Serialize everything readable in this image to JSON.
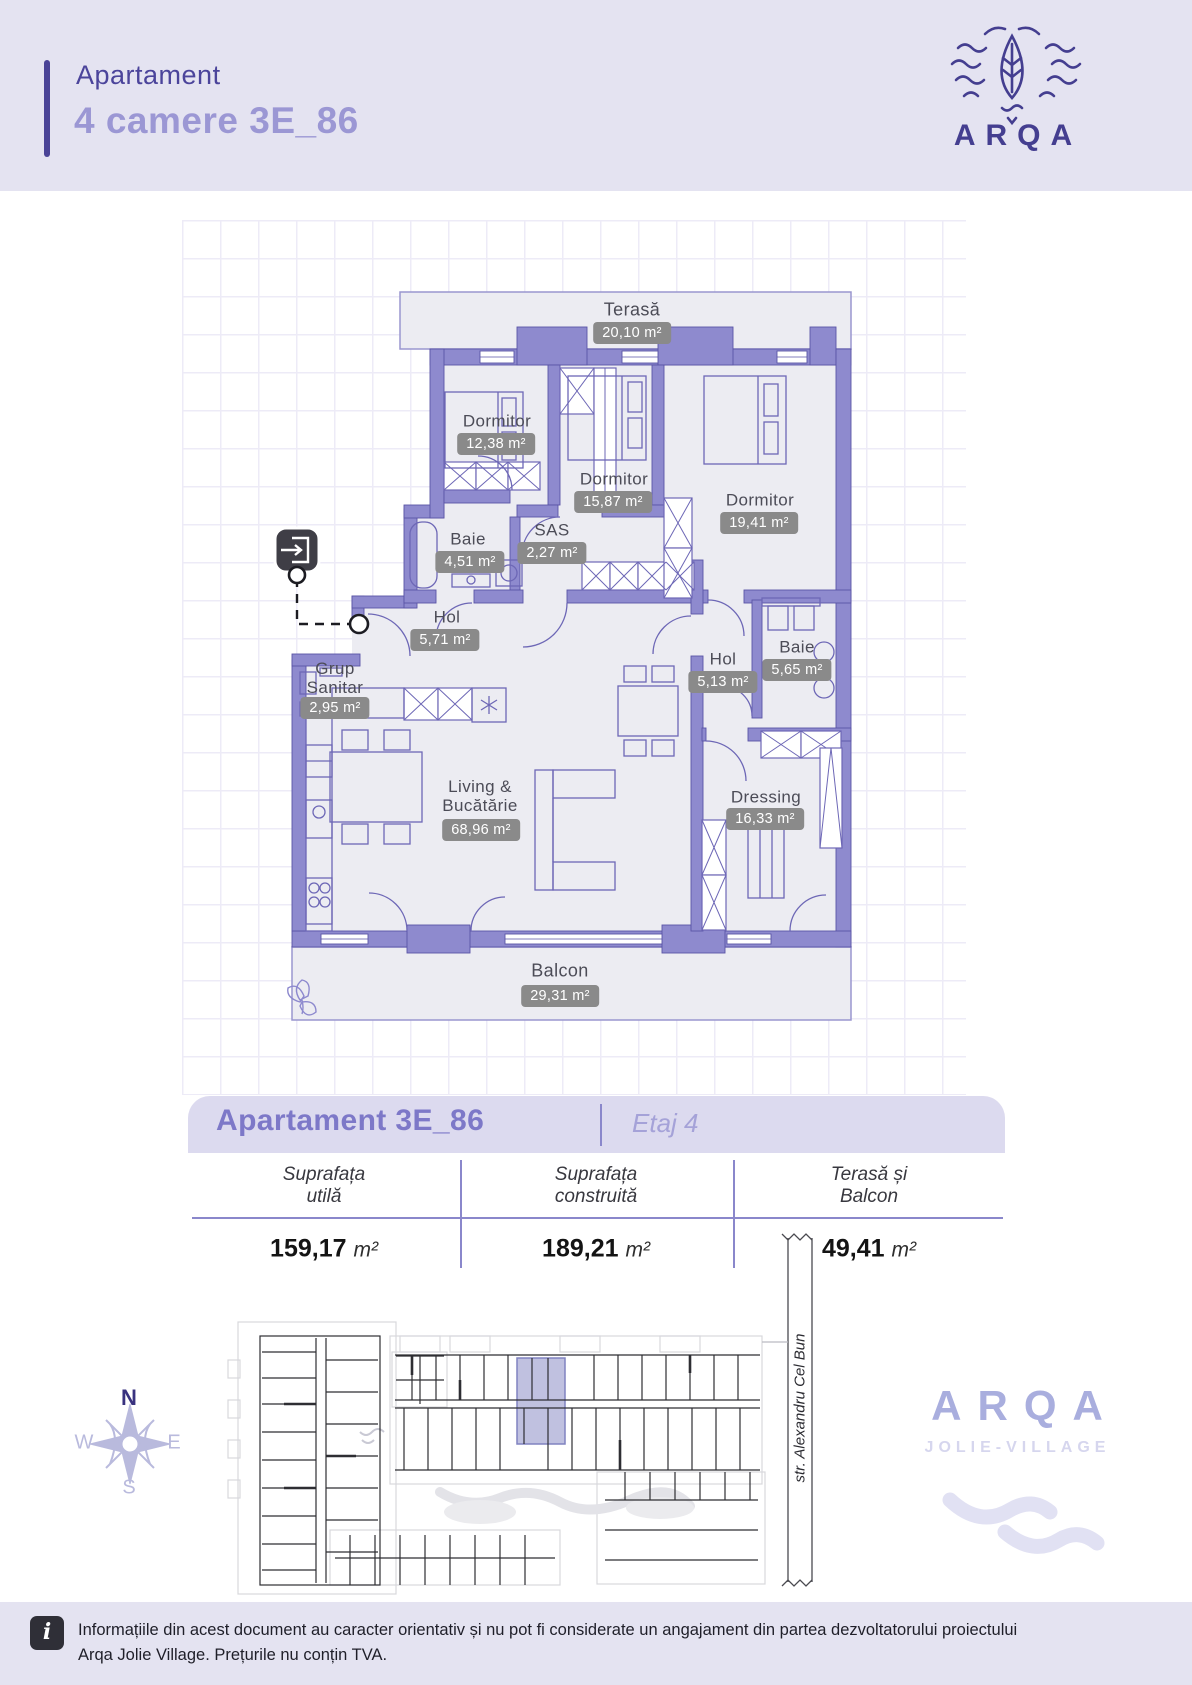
{
  "header": {
    "label": "Apartament",
    "title": "4 camere 3E_86"
  },
  "brand": {
    "name": "ARQA",
    "subtitle": "JOLIE-VILLAGE"
  },
  "floor_plan": {
    "rooms": [
      {
        "name": "Terasă",
        "area": "20,10 m²"
      },
      {
        "name": "Dormitor",
        "area": "12,38 m²"
      },
      {
        "name": "Dormitor",
        "area": "15,87 m²"
      },
      {
        "name": "Dormitor",
        "area": "19,41 m²"
      },
      {
        "name": "Baie",
        "area": "4,51 m²"
      },
      {
        "name": "SAS",
        "area": "2,27 m²"
      },
      {
        "name": "Hol",
        "area": "5,71 m²"
      },
      {
        "name": "Grup Sanitar",
        "area": "2,95 m²"
      },
      {
        "name": "Hol",
        "area": "5,13 m²"
      },
      {
        "name": "Baie",
        "area": "5,65 m²"
      },
      {
        "name": "Living & Bucătărie",
        "area": "68,96 m²"
      },
      {
        "name": "Dressing",
        "area": "16,33 m²"
      },
      {
        "name": "Balcon",
        "area": "29,31 m²"
      }
    ]
  },
  "summary": {
    "title": "Apartament 3E_86",
    "floor": "Etaj 4",
    "columns": [
      {
        "label_line1": "Suprafața",
        "label_line2": "utilă",
        "value": "159,17",
        "unit": "m²"
      },
      {
        "label_line1": "Suprafața",
        "label_line2": "construită",
        "value": "189,21",
        "unit": "m²"
      },
      {
        "label_line1": "Terasă și",
        "label_line2": "Balcon",
        "value": "49,41",
        "unit": "m²"
      }
    ]
  },
  "site": {
    "street": "str. Alexandru Cel Bun",
    "compass": {
      "n": "N",
      "e": "E",
      "s": "S",
      "w": "W"
    }
  },
  "footer": {
    "info_icon": "i",
    "text_line1": "Informațiile din acest document au caracter orientativ și nu pot fi considerate un angajament din partea dezvoltatorului proiectului",
    "text_line2": "Arqa Jolie Village. Prețurile nu conțin TVA."
  },
  "colors": {
    "accent_dark": "#4a4397",
    "accent_light": "#9b97d4",
    "wall": "#8e8ace",
    "badge": "#8a8a8a",
    "band": "#e4e3f1",
    "highlight": "#b9badd"
  }
}
